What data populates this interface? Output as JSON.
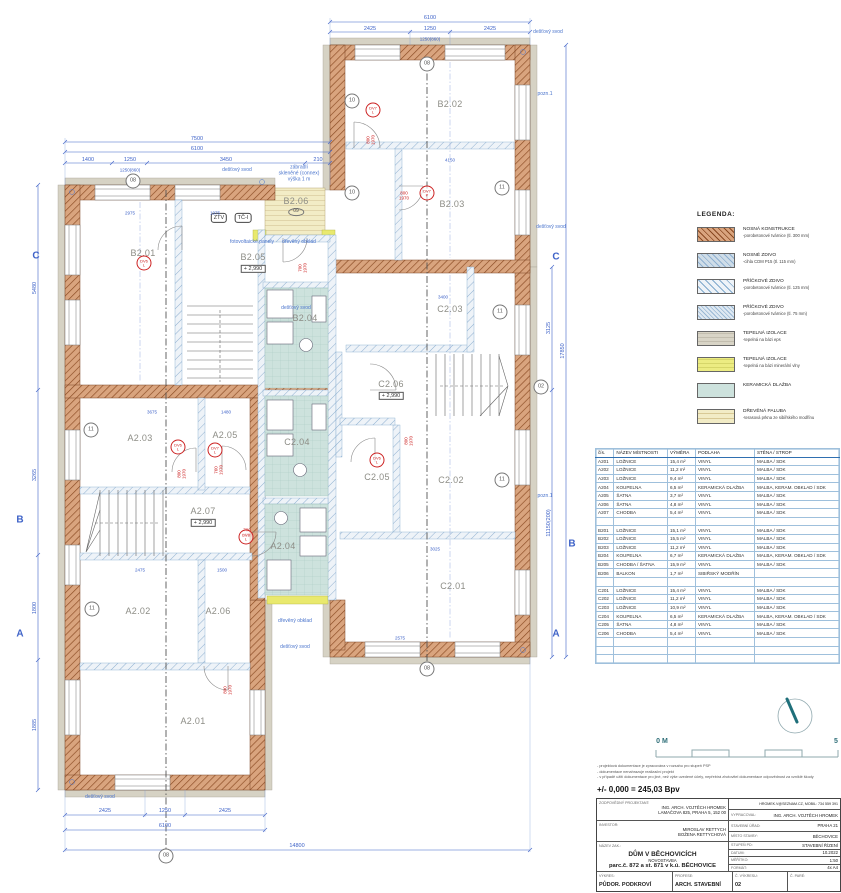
{
  "legend": {
    "title": "LEGENDA:",
    "items": [
      {
        "swatch": "loadbearing",
        "title": "NOSNÁ KONSTRUKCE",
        "desc": "-porobetonové tvárnice (tl. 300 mm)"
      },
      {
        "swatch": "masonry",
        "title": "NOSNÉ ZDIVO",
        "desc": "-cihla CDM P15 (tl. 115 mm)"
      },
      {
        "swatch": "partition125",
        "title": "PŘÍČKOVÉ ZDIVO",
        "desc": "-porobetonové tvárnice (tl. 125 mm)"
      },
      {
        "swatch": "partition75",
        "title": "PŘÍČKOVÉ ZDIVO",
        "desc": "-porobetonové tvárnice (tl. 75 mm)"
      },
      {
        "swatch": "eps",
        "title": "TEPELNÁ IZOLACE",
        "desc": "-tepelná na bázi eps"
      },
      {
        "swatch": "mineral",
        "title": "TEPELNÁ IZOLACE",
        "desc": "-tepelná na bázi minerální vlny"
      },
      {
        "swatch": "ceramic",
        "title": "KERAMICKÁ DLAŽBA",
        "desc": ""
      },
      {
        "swatch": "wood",
        "title": "DŘEVĚNÁ PALUBA",
        "desc": "-terasová prkna ze sibiřského modřínu"
      }
    ]
  },
  "room_table": {
    "headers": [
      "čís.",
      "NÁZEV MÍSTNOSTI",
      "VÝMĚRA",
      "PODLAHA",
      "STĚNA / STROP"
    ],
    "rows": [
      [
        "A201",
        "LOŽNICE",
        "15,4 m²",
        "VINYL",
        "MALBA / SDK"
      ],
      [
        "A202",
        "LOŽNICE",
        "11,2 m²",
        "VINYL",
        "MALBA / SDK"
      ],
      [
        "A203",
        "LOŽNICE",
        "9,4 m²",
        "VINYL",
        "MALBA / SDK"
      ],
      [
        "A204",
        "KOUPELNA",
        "6,5 m²",
        "KERAMICKÁ DLAŽBA",
        "MALBA, KERAM. OBKLAD / SDK"
      ],
      [
        "A205",
        "ŠATNA",
        "3,7 m²",
        "VINYL",
        "MALBA / SDK"
      ],
      [
        "A206",
        "ŠATNA",
        "4,8 m²",
        "VINYL",
        "MALBA / SDK"
      ],
      [
        "A207",
        "CHODBA",
        "5,4 m²",
        "VINYL",
        "MALBA / SDK"
      ],
      [
        "",
        "",
        "",
        "",
        ""
      ],
      [
        "B201",
        "LOŽNICE",
        "15,1 m²",
        "VINYL",
        "MALBA / SDK"
      ],
      [
        "B202",
        "LOŽNICE",
        "15,5 m²",
        "VINYL",
        "MALBA / SDK"
      ],
      [
        "B203",
        "LOŽNICE",
        "11,2 m²",
        "VINYL",
        "MALBA / SDK"
      ],
      [
        "B204",
        "KOUPELNA",
        "6,7 m²",
        "KERAMICKÁ DLAŽBA",
        "MALBA, KERAM. OBKLAD / SDK"
      ],
      [
        "B205",
        "CHODBA / ŠATNA",
        "15,9 m²",
        "VINYL",
        "MALBA / SDK"
      ],
      [
        "B206",
        "BALKON",
        "1,7 m²",
        "SIBIŘSKÝ MODŘÍN",
        ""
      ],
      [
        "",
        "",
        "",
        "",
        ""
      ],
      [
        "C201",
        "LOŽNICE",
        "15,4 m²",
        "VINYL",
        "MALBA / SDK"
      ],
      [
        "C202",
        "LOŽNICE",
        "11,2 m²",
        "VINYL",
        "MALBA / SDK"
      ],
      [
        "C203",
        "LOŽNICE",
        "10,9 m²",
        "VINYL",
        "MALBA / SDK"
      ],
      [
        "C204",
        "KOUPELNA",
        "6,5 m²",
        "KERAMICKÁ DLAŽBA",
        "MALBA, KERAM. OBKLAD / SDK"
      ],
      [
        "C205",
        "ŠATNA",
        "4,8 m²",
        "VINYL",
        "MALBA / SDK"
      ],
      [
        "C206",
        "CHODBA",
        "5,4 m²",
        "VINYL",
        "MALBA / SDK"
      ],
      [
        "",
        "",
        "",
        "",
        ""
      ],
      [
        "",
        "",
        "",
        "",
        ""
      ],
      [
        "",
        "",
        "",
        "",
        ""
      ]
    ]
  },
  "notes": [
    "- projektová dokumentace je zpracována v rozsahu pro stupeň PSP",
    "- dokumentace nenahrazuje realizační projekt",
    "- v případě užití dokumentace pro jiné, než výše uvedené účely, nepřebírá zhotovitel dokumentace odpovědnost za vzniklé škody"
  ],
  "elevation": "+/- 0,000 = 245,03 Bpv",
  "title_block": {
    "designer_label": "ZODPOVĚDNÝ PROJEKTANT:",
    "designer_name": "ING. ARCH. VOJTĚCH HROMEK",
    "designer_addr": "LAMAČOVA 825, PRAHA 5, 152 00",
    "contact": "HROMEK.V@SEZNAM.CZ, MOBIL: 734 559 391",
    "author_label": "VYPRACOVAL:",
    "author": "ING. ARCH. VOJTĚCH HROMEK",
    "investor_label": "INVESTOR:",
    "investor1": "MIROSLAV RETTYCH",
    "investor2": "BOŽENA RETTYCHOVÁ",
    "office_label": "STAVEBNÍ ÚŘAD:",
    "office": "PRAHA 21",
    "place_label": "MÍSTO STAVBY:",
    "place": "BĚCHOVICE",
    "project_label": "NÁZEV ZAK.:",
    "project1": "DŮM V BĚCHOVICÍCH",
    "project2": "NOVOSTAVBA",
    "project3": "parc.č. 872 a st. 871 v k.ú. BĚCHOVICE",
    "stage_label": "STUPEŇ PD:",
    "stage": "STAVEBNÍ ŘÍZENÍ",
    "date_label": "DATUM:",
    "date": "10.2022",
    "scale_label": "MĚŘÍTKO:",
    "scale": "1:50",
    "format_label": "FORMÁT:",
    "format": "4x A4",
    "drawing_label": "VÝKRES:",
    "drawing": "PŮDOR. PODKROVÍ",
    "profession_label": "PROFESE:",
    "profession": "ARCH. STAVEBNÍ",
    "number_label": "Č. VÝKRESU:",
    "number": "02",
    "copy_label": "Č. PARÉ:"
  },
  "plan": {
    "rooms": [
      [
        "B2.02",
        450,
        104
      ],
      [
        "B2.03",
        452,
        204
      ],
      [
        "B2.06",
        296,
        201
      ],
      [
        "B2.01",
        143,
        253
      ],
      [
        "B2.05",
        253,
        257
      ],
      [
        "B2.04",
        305,
        318
      ],
      [
        "C2.03",
        450,
        309
      ],
      [
        "C2.06",
        391,
        384
      ],
      [
        "C2.04",
        297,
        442
      ],
      [
        "A2.03",
        140,
        438
      ],
      [
        "A2.05",
        225,
        435
      ],
      [
        "A2.07",
        203,
        511
      ],
      [
        "A2.04",
        283,
        546
      ],
      [
        "C2.05",
        377,
        477
      ],
      [
        "C2.02",
        451,
        480
      ],
      [
        "C2.01",
        453,
        586
      ],
      [
        "A2.02",
        138,
        611
      ],
      [
        "A2.06",
        218,
        611
      ],
      [
        "A2.01",
        193,
        721
      ]
    ],
    "levels": [
      [
        "+ 2,990",
        253,
        269
      ],
      [
        "+ 2,990",
        391,
        396
      ],
      [
        "+ 2,990",
        203,
        523
      ]
    ],
    "tags": [
      [
        "ZTV",
        219,
        218
      ],
      [
        "TČ-I",
        243,
        218
      ]
    ],
    "ellipses": [
      [
        "09",
        296,
        212
      ]
    ],
    "markers": [
      [
        "08",
        427,
        64
      ],
      [
        "08",
        133,
        181
      ],
      [
        "08",
        427,
        669
      ],
      [
        "08",
        166,
        856
      ],
      [
        "02",
        541,
        387
      ],
      [
        "10",
        352,
        101
      ],
      [
        "10",
        352,
        193
      ],
      [
        "11",
        502,
        188
      ],
      [
        "11",
        500,
        312
      ],
      [
        "11",
        91,
        430
      ],
      [
        "11",
        502,
        480
      ],
      [
        "11",
        92,
        609
      ]
    ],
    "grid_letters": [
      [
        "C",
        36,
        256
      ],
      [
        "B",
        20,
        520
      ],
      [
        "A",
        20,
        634
      ],
      [
        "C",
        556,
        257
      ],
      [
        "B",
        572,
        544
      ],
      [
        "A",
        556,
        634
      ]
    ],
    "annotations": [
      [
        "dešťový svod",
        237,
        171
      ],
      [
        "zábradlí\nskleněné (connex)\nvýška 1 m",
        299,
        174
      ],
      [
        "fotovoltaické panely",
        252,
        243
      ],
      [
        "dřevěný obklad",
        299,
        243
      ],
      [
        "dešťový svod",
        296,
        309
      ],
      [
        "dřevěný obklad",
        295,
        622
      ],
      [
        "dešťový svod",
        295,
        648
      ],
      [
        "dešťový svod",
        548,
        33
      ],
      [
        "dešťový svod",
        551,
        228
      ],
      [
        "dešťový svod",
        100,
        798
      ],
      [
        "pozn.1",
        545,
        95
      ],
      [
        "pozn.1",
        545,
        497
      ]
    ],
    "dims": [
      [
        "6100",
        430,
        18,
        ""
      ],
      [
        "2425",
        370,
        29,
        ""
      ],
      [
        "1250",
        430,
        29,
        ""
      ],
      [
        "2425",
        490,
        29,
        ""
      ],
      [
        "1250(860)",
        430,
        39,
        "s"
      ],
      [
        "7500",
        197,
        139,
        ""
      ],
      [
        "6100",
        197,
        149,
        ""
      ],
      [
        "1400",
        88,
        160,
        ""
      ],
      [
        "1250",
        130,
        160,
        ""
      ],
      [
        "3450",
        226,
        160,
        ""
      ],
      [
        "210",
        318,
        160,
        ""
      ],
      [
        "1250(860)",
        130,
        170,
        "s"
      ],
      [
        "5480",
        35,
        288,
        "r"
      ],
      [
        "3265",
        35,
        475,
        "r"
      ],
      [
        "1800",
        35,
        608,
        "r"
      ],
      [
        "1885",
        35,
        725,
        "r"
      ],
      [
        "3125",
        549,
        328,
        "r"
      ],
      [
        "11150(200)",
        549,
        523,
        "r"
      ],
      [
        "17850",
        563,
        351,
        "r"
      ],
      [
        "2425",
        105,
        811,
        ""
      ],
      [
        "1250",
        165,
        811,
        ""
      ],
      [
        "2425",
        225,
        811,
        ""
      ],
      [
        "6100",
        165,
        826,
        ""
      ],
      [
        "14800",
        297,
        846,
        ""
      ],
      [
        "4150",
        450,
        160,
        "s"
      ],
      [
        "3400",
        443,
        297,
        "s"
      ],
      [
        "2975",
        130,
        213,
        "s"
      ],
      [
        "1975",
        215,
        213,
        "s"
      ],
      [
        "3675",
        152,
        412,
        "s"
      ],
      [
        "1480",
        226,
        412,
        "s"
      ],
      [
        "2475",
        140,
        570,
        "s"
      ],
      [
        "1500",
        222,
        570,
        "s"
      ],
      [
        "3025",
        435,
        549,
        "s"
      ],
      [
        "2575",
        400,
        638,
        "s"
      ]
    ],
    "red_labels": [
      [
        "800\n1970",
        371,
        140,
        "r"
      ],
      [
        "800\n1970",
        404,
        196,
        ""
      ],
      [
        "700\n1970",
        303,
        268,
        "r"
      ],
      [
        "800\n1970",
        182,
        474,
        "r"
      ],
      [
        "760\n1970",
        219,
        470,
        "r"
      ],
      [
        "700\n1970",
        247,
        533,
        ""
      ],
      [
        "800\n1970",
        409,
        441,
        "r"
      ],
      [
        "800\n1970",
        228,
        690,
        "r"
      ]
    ],
    "red_circles": [
      [
        "DV7\nL",
        373,
        110
      ],
      [
        "DV6\nL",
        144,
        263
      ],
      [
        "DV7\nP",
        427,
        193
      ],
      [
        "DV6\nL",
        178,
        447
      ],
      [
        "DV7\nL",
        215,
        450
      ],
      [
        "DV6\nL",
        377,
        460
      ],
      [
        "DV8\nL",
        246,
        537
      ]
    ],
    "misc": [
      [
        "0 M",
        662,
        742
      ],
      [
        "5",
        836,
        742
      ]
    ]
  }
}
